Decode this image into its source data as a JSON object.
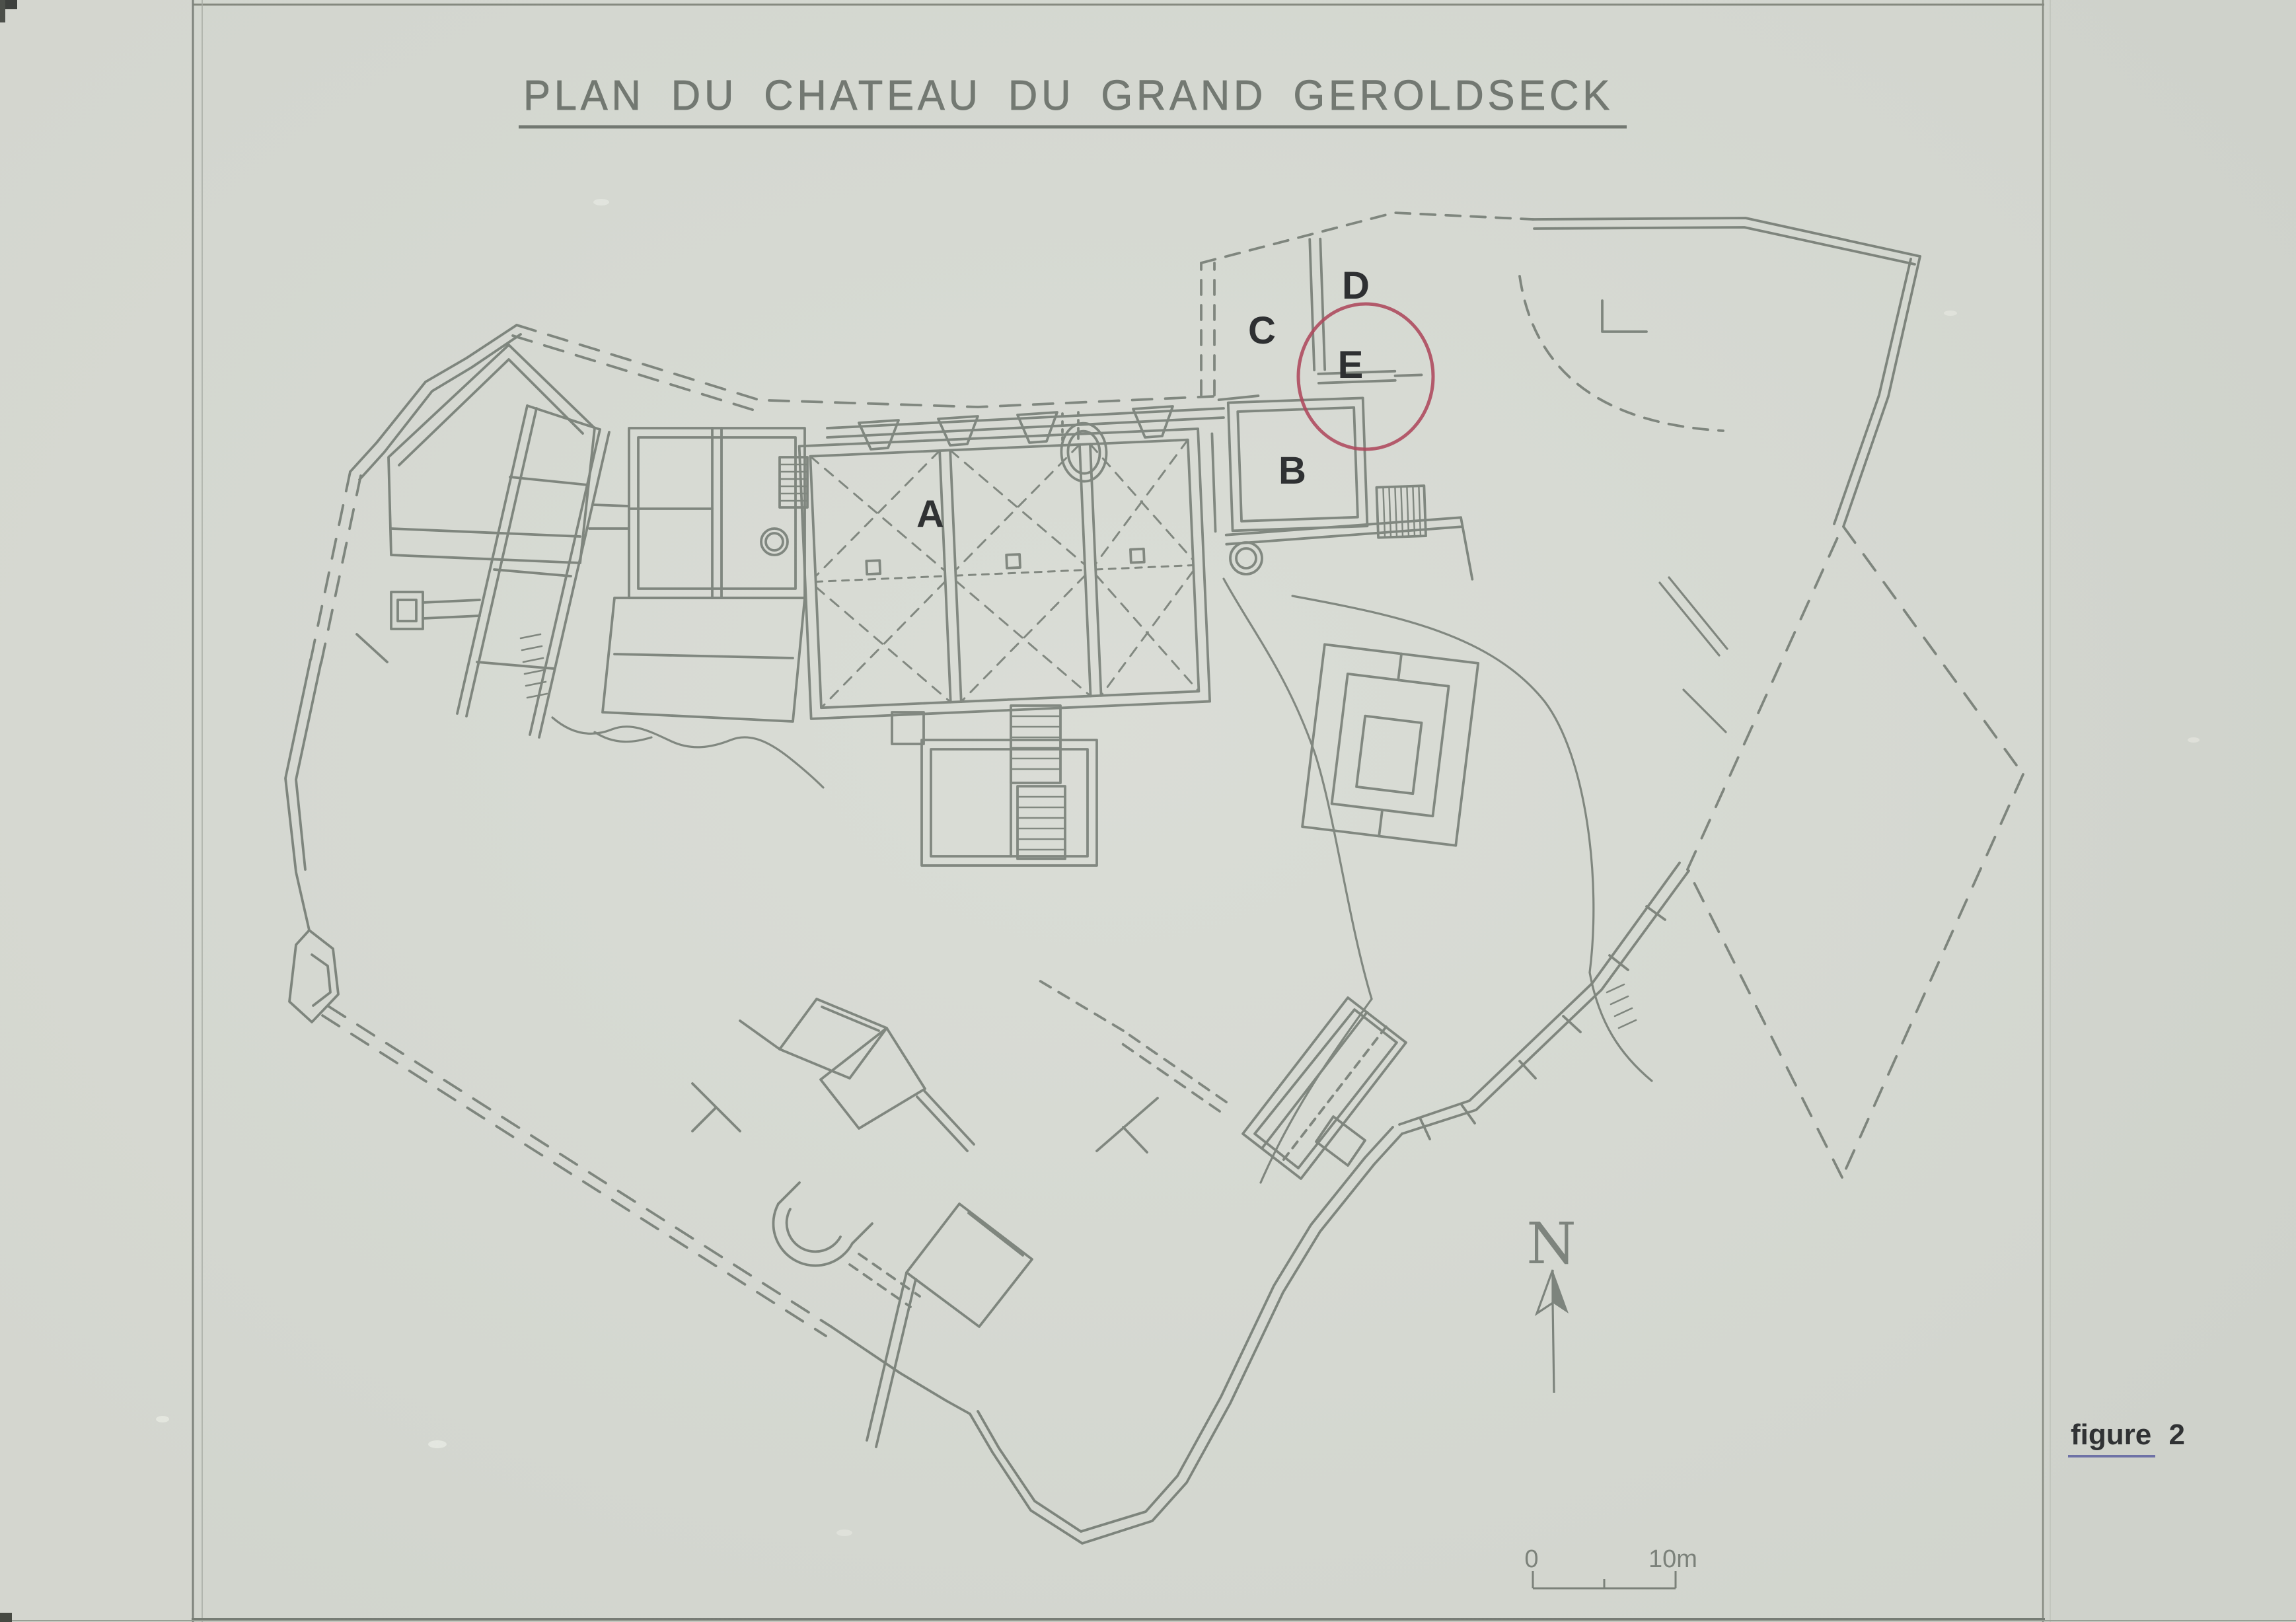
{
  "title": {
    "text": "PLAN DU CHATEAU DU GRAND GEROLDSECK"
  },
  "plan_labels": {
    "A": "A",
    "B": "B",
    "C": "C",
    "D": "D",
    "E": "E"
  },
  "north_indicator": {
    "label": "N"
  },
  "scale_bar": {
    "start_label": "0",
    "end_label": "10m"
  },
  "figure_caption": {
    "text": "figure 2"
  },
  "colors": {
    "paper": "#d8dbd4",
    "plan_ink": "#7c837b",
    "label_ink": "#26282a",
    "title_ink": "#70766f",
    "highlight_circle": "#ac4156",
    "figure_underline": "#6e71a9"
  }
}
